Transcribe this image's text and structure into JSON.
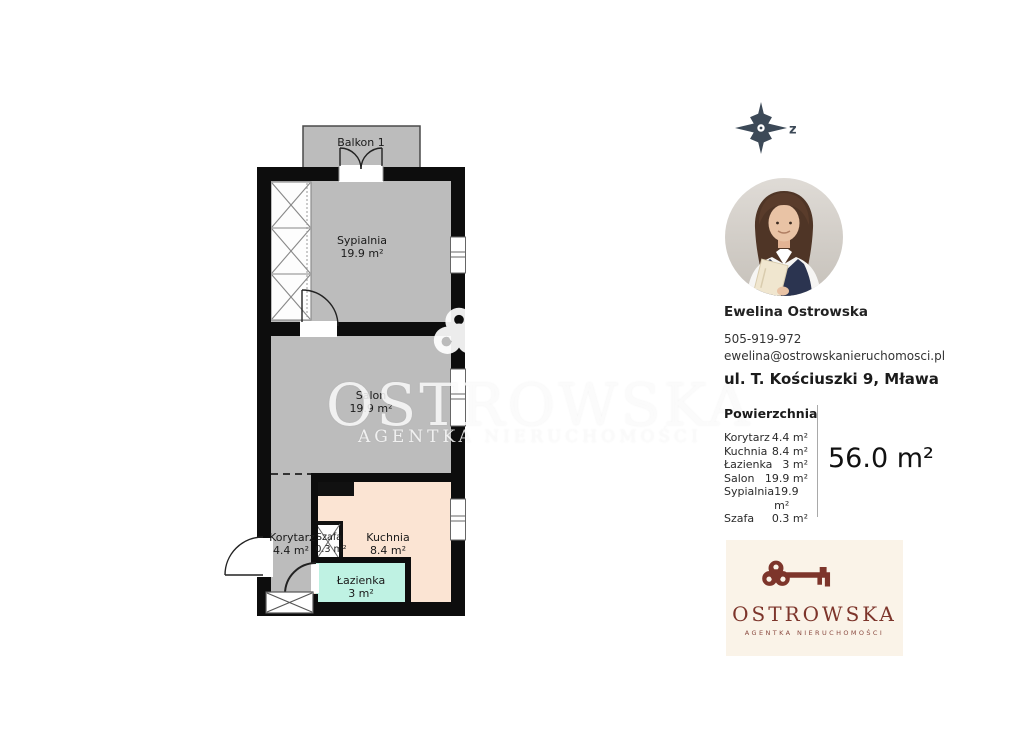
{
  "compass": {
    "direction_label": "z"
  },
  "floor_plan": {
    "balcony_label": "Balkon 1",
    "rooms": {
      "sypialnia": {
        "name": "Sypialnia",
        "area": "19.9 m²"
      },
      "salon": {
        "name": "Salon",
        "area": "19.9 m²"
      },
      "kuchnia": {
        "name": "Kuchnia",
        "area": "8.4 m²"
      },
      "korytarz": {
        "name": "Korytarz",
        "area": "4.4 m²"
      },
      "lazienka": {
        "name": "Łazienka",
        "area": "3 m²"
      },
      "szafa": {
        "name": "Szafa",
        "area": "0.3 m²"
      }
    },
    "colors": {
      "wall": "#0d0d0d",
      "room_fill": "#bdbdbd",
      "kitchen_fill": "#fbe4d3",
      "bathroom_fill": "#bff2e3"
    }
  },
  "agent": {
    "name": "Ewelina Ostrowska",
    "phone": "505-919-972",
    "email": "ewelina@ostrowskanieruchomosci.pl",
    "address": "ul. T. Kościuszki 9, Mława"
  },
  "areas": {
    "title": "Powierzchnia",
    "rows": [
      {
        "label": "Korytarz",
        "value": "4.4 m²"
      },
      {
        "label": "Kuchnia",
        "value": "8.4 m²"
      },
      {
        "label": "Łazienka",
        "value": "3 m²"
      },
      {
        "label": "Salon",
        "value": "19.9 m²"
      },
      {
        "label": "Sypialnia",
        "value": "19.9 m²"
      },
      {
        "label": "Szafa",
        "value": "0.3 m²"
      }
    ],
    "total": "56.0 m²"
  },
  "brand": {
    "name": "OSTROWSKA",
    "tagline": "AGENTKA NIERUCHOMOŚCI",
    "colors": {
      "maroon": "#7d352b",
      "card_bg": "#faf3e8",
      "compass": "#3c4957"
    }
  },
  "watermark": {
    "line1": "OSTROWSKA",
    "line2": "AGENTKA NIERUCHOMOŚCI"
  }
}
